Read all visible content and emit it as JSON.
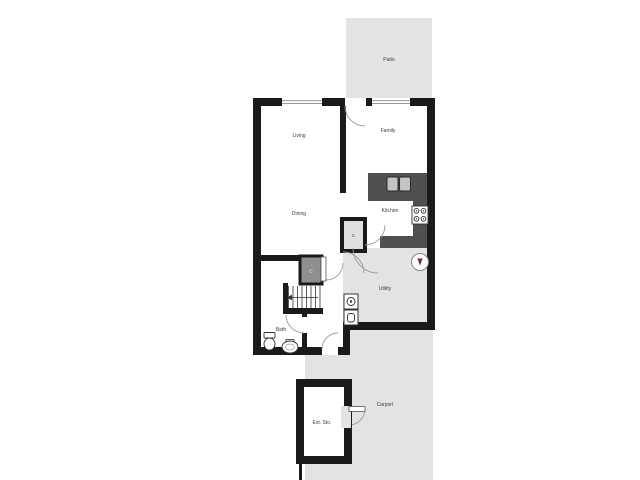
{
  "floorplan": {
    "rooms": [
      {
        "id": "patio",
        "label": "Patio"
      },
      {
        "id": "living",
        "label": "Living"
      },
      {
        "id": "family",
        "label": "Family"
      },
      {
        "id": "dining",
        "label": "Dining"
      },
      {
        "id": "kitchen",
        "label": "Kitchen"
      },
      {
        "id": "utility",
        "label": "Utility"
      },
      {
        "id": "bath",
        "label": "Bath"
      },
      {
        "id": "carport",
        "label": "Carport"
      },
      {
        "id": "ext_storage",
        "label": "Ext. Sto."
      },
      {
        "id": "closet_pantry",
        "label": "C"
      },
      {
        "id": "closet_hall",
        "label": "C"
      }
    ],
    "fixtures": [
      "kitchen-sink",
      "stove",
      "water-heater",
      "washer",
      "dryer",
      "toilet",
      "bath-sink",
      "stairs-up",
      "windows",
      "doors"
    ],
    "colors": {
      "wall": "#1a1a1a",
      "outdoor_gray": "#e3e3e3",
      "counter_gray": "#4f4f4f",
      "closet_dark_gray": "#8f8f8f",
      "door_arc": "#999999",
      "heater_arrow": "#7a2e2e"
    }
  }
}
